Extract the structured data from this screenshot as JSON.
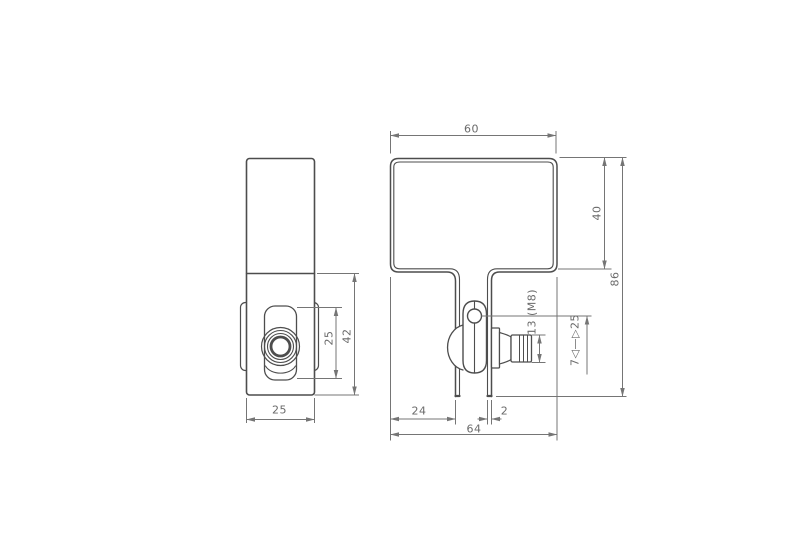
{
  "drawing": {
    "type": "technical-drawing",
    "description": "Two-view orthographic CAD drawing of a sheet-metal clamp bracket with thumb-screw lever",
    "colors": {
      "background": "#ffffff",
      "part_line": "#4d4d4d",
      "dimension_line": "#757575",
      "text": "#6a6a6a"
    },
    "views": [
      {
        "name": "side-view",
        "position": "left"
      },
      {
        "name": "front-view",
        "position": "right"
      }
    ],
    "labels": {
      "front_width_top": "60",
      "front_box_height": "40",
      "front_total_height": "86",
      "bolt_spec": "13 (M8)",
      "clamp_range": "7◁—▷25",
      "leg_offset": "24",
      "leg_thickness": "2",
      "front_width_total": "64",
      "side_slot_height": "25",
      "side_lower_height": "42",
      "side_width": "25"
    }
  }
}
